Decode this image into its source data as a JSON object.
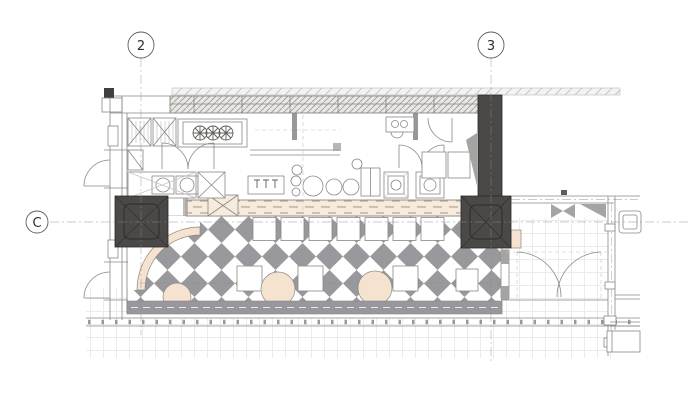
{
  "drawing": {
    "grid_markers": {
      "column_2": "2",
      "column_3": "3",
      "row_c": "C"
    }
  },
  "colors": {
    "paper": "#ffffff",
    "line_dark": "#5e5d5a",
    "line_mid": "#8a8886",
    "line_light": "#c6c4c1",
    "tile_grid": "#ecebe7",
    "column_fill": "#4a4947",
    "column_line": "#2c2b29",
    "checker_gray": "#99989c",
    "band_gray": "#98979b",
    "peach_fill": "#f5e2cf",
    "peach_band": "#f6ebdd",
    "peach_dash": "#bba892",
    "hatch_fill": "#e9e7e4",
    "hatch_line": "#a5a3a0",
    "wedge_gray": "#a5a4a2",
    "gridline": "#8c8a92"
  }
}
